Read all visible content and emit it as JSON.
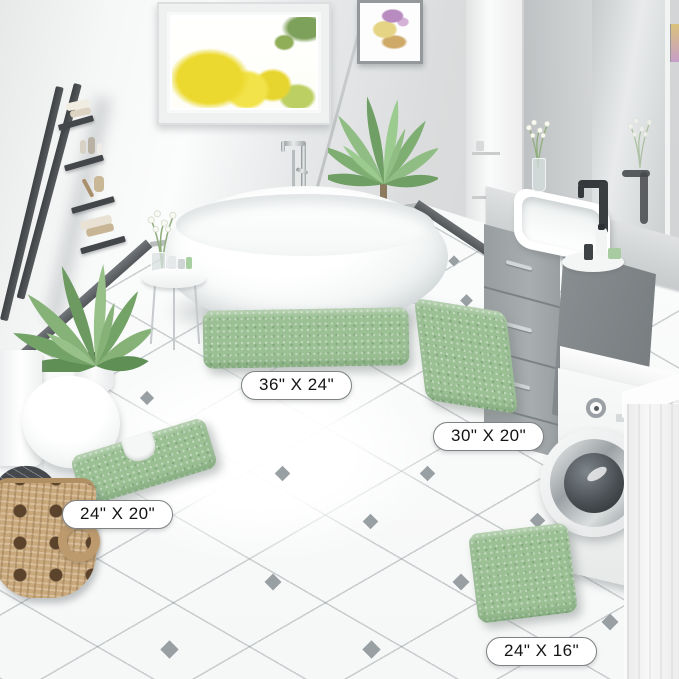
{
  "scene": {
    "setting": "bathroom",
    "product": "sage green chenille bath rug 4-piece set"
  },
  "size_labels": {
    "rug_36x24": "36\" X 24\"",
    "rug_30x20": "30\" X 20\"",
    "contour_24x20": "24\" X 20\"",
    "rug_24x16": "24\" X 16\""
  },
  "colors": {
    "rug_green": "#9bc094",
    "floor_white": "#f6f7f7",
    "wall_gray": "#d9dbdc",
    "vanity_gray": "#9aa0a2",
    "label_border": "#7e8285",
    "window_tree_yellow": "#ecd92f"
  }
}
